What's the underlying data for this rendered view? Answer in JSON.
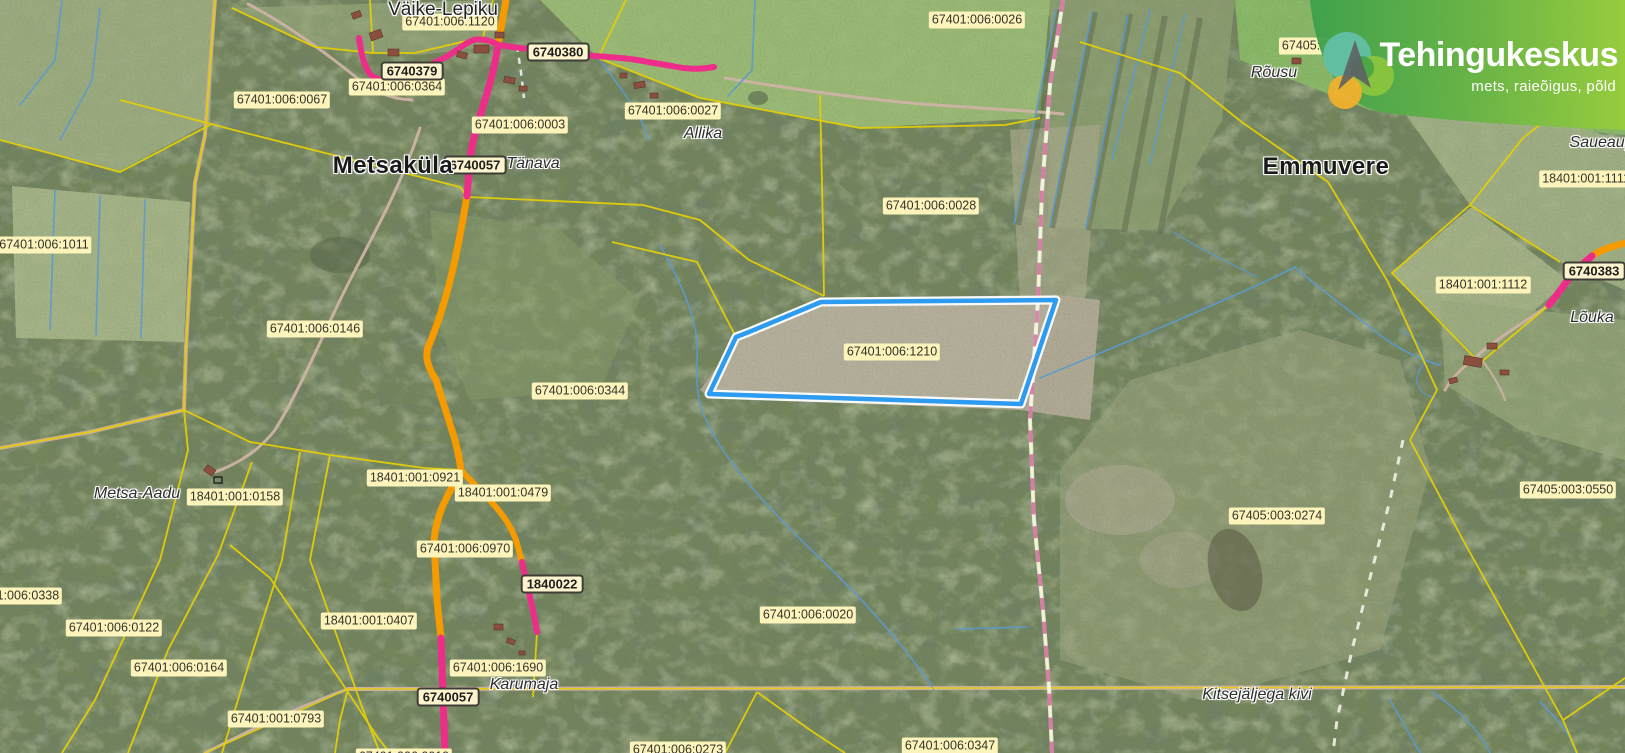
{
  "brand": {
    "title": "Tehingukeskus",
    "subtitle": "mets, raieõigus, põld"
  },
  "map": {
    "selected_parcel_code": "67401:006:1210",
    "colors": {
      "boundary-yellow": "#e4cf05",
      "stream-blue": "#5b9ad0",
      "road-orange": "#f59b00",
      "road-magenta": "#ee2d8b",
      "selection-blue": "#2d9cf0",
      "label-bg": "#fcf4bb",
      "label-text": "#33332b",
      "badge-bg": "#fdf3cf",
      "badge-border": "#3d3d35",
      "boundary-pink": "#d06a9a",
      "logo-green-dark": "#3da04b",
      "logo-green-light": "#97cd3c"
    },
    "labels": [
      {
        "kind": "parcel",
        "text": "67401:006:1120",
        "x": 450,
        "y": 22
      },
      {
        "kind": "parcel",
        "text": "67401:006:0364",
        "x": 397,
        "y": 87
      },
      {
        "kind": "parcel",
        "text": "67401:006:0067",
        "x": 282,
        "y": 100
      },
      {
        "kind": "parcel",
        "text": "67401:006:0003",
        "x": 520,
        "y": 125
      },
      {
        "kind": "parcel",
        "text": "67401:006:0027",
        "x": 673,
        "y": 111
      },
      {
        "kind": "parcel",
        "text": "67401:006:0026",
        "x": 977,
        "y": 20
      },
      {
        "kind": "parcel",
        "text": "67401:006:0028",
        "x": 931,
        "y": 206
      },
      {
        "kind": "parcel",
        "text": "67401:006:1011",
        "x": 44,
        "y": 245
      },
      {
        "kind": "parcel",
        "text": "67401:006:0146",
        "x": 315,
        "y": 329
      },
      {
        "kind": "parcel",
        "text": "67401:006:0344",
        "x": 580,
        "y": 391
      },
      {
        "kind": "parcel",
        "text": "67401:006:1210",
        "x": 892,
        "y": 352
      },
      {
        "kind": "parcel",
        "text": "67405:00",
        "x": 1308,
        "y": 46
      },
      {
        "kind": "parcel",
        "text": "18401:001:1111",
        "x": 1586,
        "y": 179
      },
      {
        "kind": "parcel",
        "text": "18401:001:1112",
        "x": 1483,
        "y": 285
      },
      {
        "kind": "parcel",
        "text": "67405:003:0550",
        "x": 1568,
        "y": 490
      },
      {
        "kind": "parcel",
        "text": "67405:003:0274",
        "x": 1277,
        "y": 516
      },
      {
        "kind": "parcel",
        "text": "18401:001:0158",
        "x": 235,
        "y": 497
      },
      {
        "kind": "parcel",
        "text": "18401:001:0921",
        "x": 415,
        "y": 478
      },
      {
        "kind": "parcel",
        "text": "18401:001:0479",
        "x": 503,
        "y": 493
      },
      {
        "kind": "parcel",
        "text": "67401:006:0970",
        "x": 465,
        "y": 549
      },
      {
        "kind": "parcel",
        "text": "67401:006:0338",
        "x": 14,
        "y": 596
      },
      {
        "kind": "parcel",
        "text": "67401:006:0122",
        "x": 114,
        "y": 628
      },
      {
        "kind": "parcel",
        "text": "18401:001:0407",
        "x": 369,
        "y": 621
      },
      {
        "kind": "parcel",
        "text": "67401:006:0164",
        "x": 179,
        "y": 668
      },
      {
        "kind": "parcel",
        "text": "67401:006:1690",
        "x": 498,
        "y": 668
      },
      {
        "kind": "parcel",
        "text": "67401:001:0793",
        "x": 276,
        "y": 719
      },
      {
        "kind": "parcel",
        "text": "67401:006:0020",
        "x": 808,
        "y": 615
      },
      {
        "kind": "parcel",
        "text": "67401:006:0273",
        "x": 678,
        "y": 750
      },
      {
        "kind": "parcel",
        "text": "67401:006:0347",
        "x": 950,
        "y": 746
      },
      {
        "kind": "parcel",
        "text": "67401:006:0019",
        "x": 404,
        "y": 757
      },
      {
        "kind": "badge",
        "text": "6740380",
        "x": 558,
        "y": 52
      },
      {
        "kind": "badge",
        "text": "6740379",
        "x": 412,
        "y": 71
      },
      {
        "kind": "badge",
        "text": "6740057",
        "x": 475,
        "y": 165
      },
      {
        "kind": "badge",
        "text": "1840022",
        "x": 552,
        "y": 584
      },
      {
        "kind": "badge",
        "text": "6740057",
        "x": 448,
        "y": 697
      },
      {
        "kind": "badge",
        "text": "6740383",
        "x": 1594,
        "y": 271
      },
      {
        "kind": "place",
        "text": "Tänava",
        "x": 533,
        "y": 164
      },
      {
        "kind": "place",
        "text": "Allika",
        "x": 703,
        "y": 134
      },
      {
        "kind": "place",
        "text": "Rõusu",
        "x": 1274,
        "y": 73
      },
      {
        "kind": "place",
        "text": "Lõuka",
        "x": 1592,
        "y": 318
      },
      {
        "kind": "place",
        "text": "Saueaugu",
        "x": 1606,
        "y": 143
      },
      {
        "kind": "place",
        "text": "Metsa-Aadu",
        "x": 137,
        "y": 494
      },
      {
        "kind": "place",
        "text": "Karumaja",
        "x": 524,
        "y": 685
      },
      {
        "kind": "place",
        "text": "Kitsejäljega kivi",
        "x": 1257,
        "y": 695
      },
      {
        "kind": "farm",
        "text": "Väike-Lepiku",
        "x": 443,
        "y": 10
      },
      {
        "kind": "village",
        "text": "Metsaküla",
        "x": 393,
        "y": 166
      },
      {
        "kind": "village",
        "text": "Emmuvere",
        "x": 1326,
        "y": 167
      }
    ]
  }
}
